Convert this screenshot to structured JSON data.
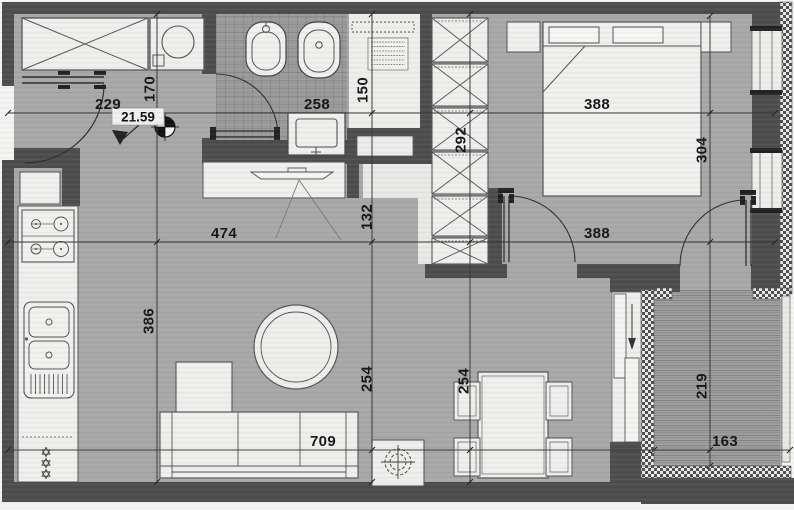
{
  "area_marker": {
    "value": "21.59"
  },
  "dimensions": {
    "entry_width": "229",
    "entry_depth": "170",
    "bath_width": "258",
    "shower_width": "150",
    "closet_run": "292",
    "bed_width": "388",
    "bedroom_depth": "304",
    "living_width": "474",
    "console_offset": "132",
    "kitchen_run": "386",
    "sofa_zone_depth": "254",
    "dining_zone_depth": "254",
    "bedroom_opening": "388",
    "living_span": "709",
    "balcony_depth": "219",
    "balcony_width": "163"
  },
  "palette": {
    "wall": "#4d4d4d",
    "floor": "#a8a8a8",
    "fixture_white": "#efefed",
    "ink": "#161616"
  }
}
